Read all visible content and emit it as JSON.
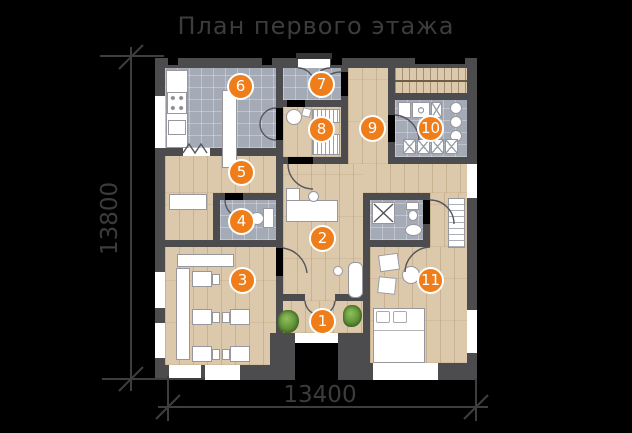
{
  "title": "План первого этажа",
  "dimensions": {
    "height_total": "13800",
    "width_total": "13400"
  },
  "rooms": [
    {
      "number": "1"
    },
    {
      "number": "2"
    },
    {
      "number": "3"
    },
    {
      "number": "4"
    },
    {
      "number": "5"
    },
    {
      "number": "6"
    },
    {
      "number": "7"
    },
    {
      "number": "8"
    },
    {
      "number": "9"
    },
    {
      "number": "10"
    },
    {
      "number": "11"
    }
  ],
  "colors": {
    "background": "#000000",
    "marker": "#ee7d1a",
    "wall": "#4c4c4f",
    "wood_floor": "#dcc9ab",
    "tile_floor": "#a4abb6",
    "annotation": "#3d3d3d",
    "furniture": "#ffffff",
    "plant": "#69a03e"
  }
}
